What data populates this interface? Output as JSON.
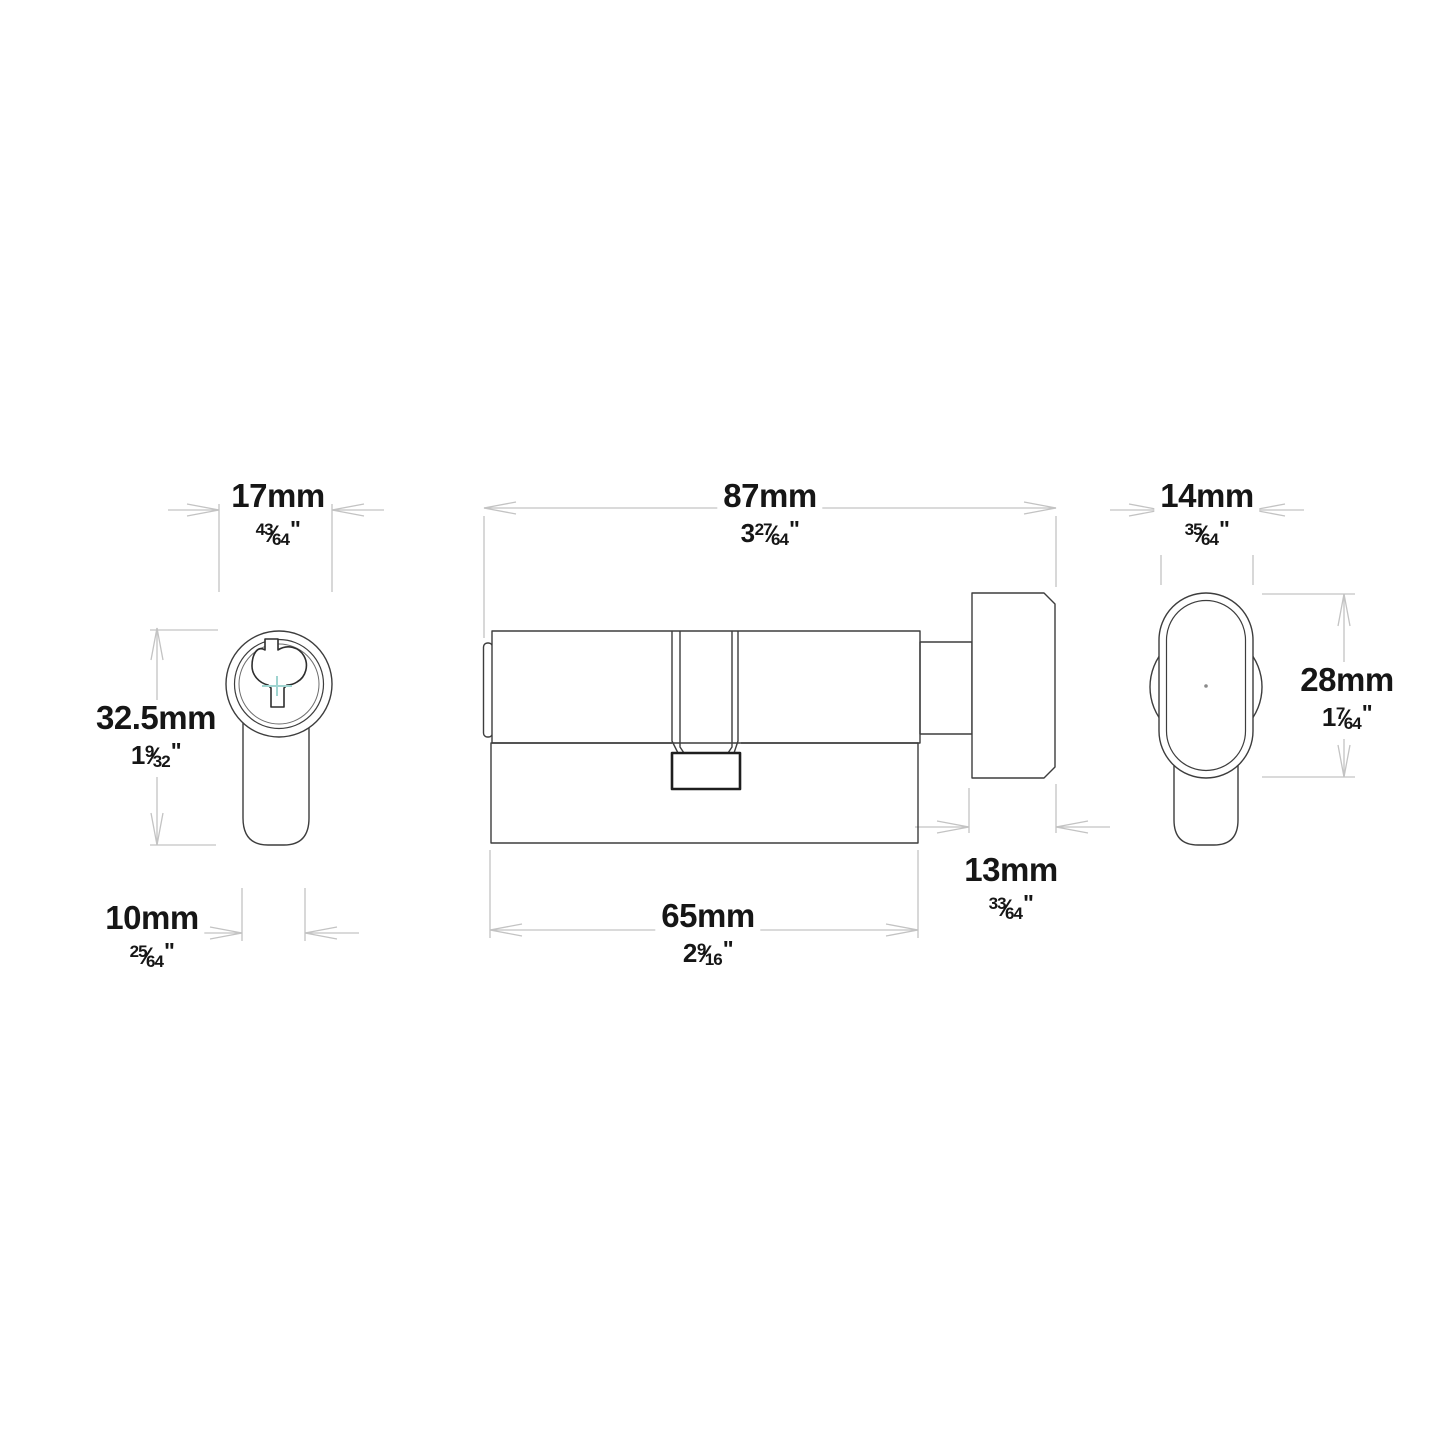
{
  "style": {
    "line_color": "#3d3d3d",
    "dim_color": "#c3c3c3",
    "text_color": "#161616",
    "keyway_cross_color": "#9fd4d0",
    "cam_line_color": "#1e1e1e",
    "background": "#ffffff"
  },
  "dimensions": {
    "d17": {
      "mm": "17mm",
      "whole": "",
      "num": "43",
      "den": "64",
      "slash": "⁄",
      "inch": "\""
    },
    "d87": {
      "mm": "87mm",
      "whole": "3",
      "num": "27",
      "den": "64",
      "slash": "⁄",
      "inch": "\""
    },
    "d14": {
      "mm": "14mm",
      "whole": "",
      "num": "35",
      "den": "64",
      "slash": "⁄",
      "inch": "\""
    },
    "d325": {
      "mm": "32.5mm",
      "whole": "1",
      "num": "9",
      "den": "32",
      "slash": "⁄",
      "inch": "\""
    },
    "d28": {
      "mm": "28mm",
      "whole": "1",
      "num": "7",
      "den": "64",
      "slash": "⁄",
      "inch": "\""
    },
    "d10": {
      "mm": "10mm",
      "whole": "",
      "num": "25",
      "den": "64",
      "slash": "⁄",
      "inch": "\""
    },
    "d65": {
      "mm": "65mm",
      "whole": "2",
      "num": "9",
      "den": "16",
      "slash": "⁄",
      "inch": "\""
    },
    "d13": {
      "mm": "13mm",
      "whole": "",
      "num": "33",
      "den": "64",
      "slash": "⁄",
      "inch": "\""
    }
  }
}
